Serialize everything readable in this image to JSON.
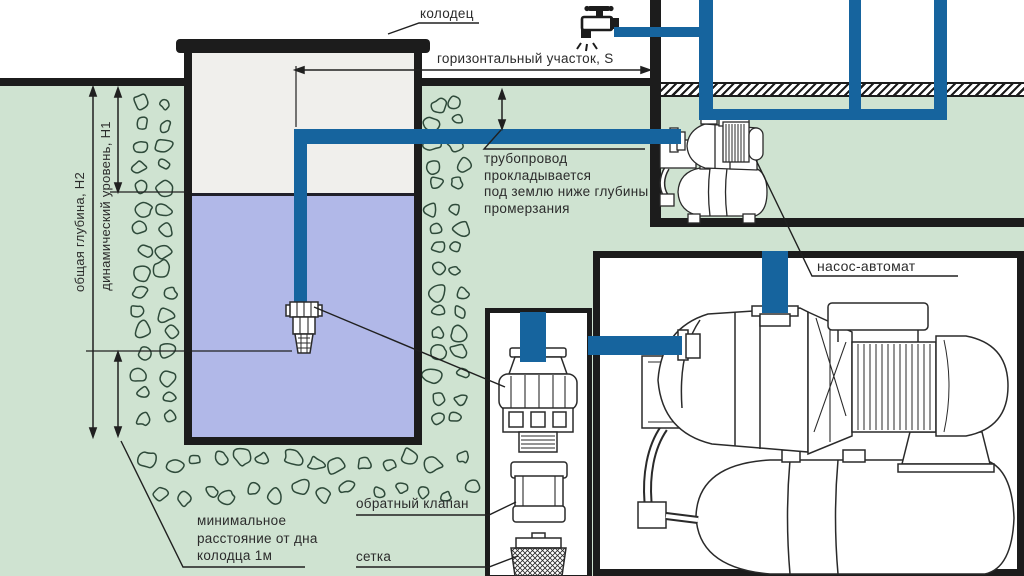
{
  "labels": {
    "well": "колодец",
    "horizontal_section": "горизонтальный участок, S",
    "pipeline_note": [
      "трубопровод",
      "прокладывается",
      "под землю ниже глубины",
      "промерзания"
    ],
    "total_depth": "общая глубина, Н2",
    "dynamic_level": "динамический уровень, Н1",
    "min_distance": [
      "минимальное",
      "расстояние от дна",
      "колодца 1м"
    ],
    "check_valve": "обратный клапан",
    "strainer": "сетка",
    "pump_station": "насос-автомат"
  },
  "icons": {
    "faucet": "faucet-icon"
  },
  "colors": {
    "ground": "#cfe3d1",
    "water": "#b1b8e8",
    "pipe": "#16649e",
    "outline": "#1c1c1c",
    "well_interior": "#f0efec",
    "stone_outline": "#2e4a3a"
  }
}
